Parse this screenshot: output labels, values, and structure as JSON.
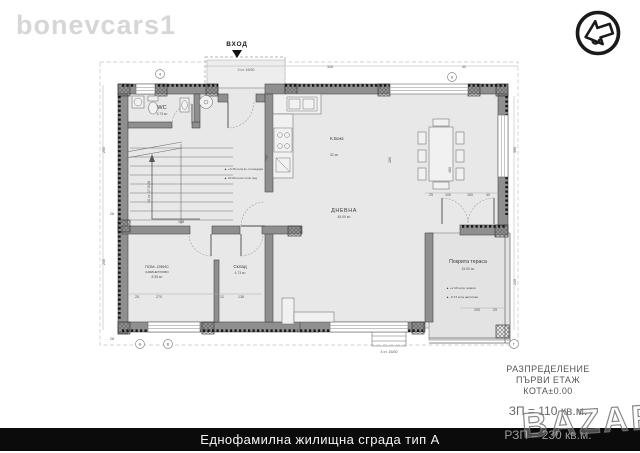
{
  "brand": "bonevcars1",
  "bazar_watermark": "BAZAR",
  "logo": {
    "name": "arrow-logo"
  },
  "footer": {
    "title": "Еднофамилна жилищна сграда тип А"
  },
  "title_block": {
    "line1": "РАЗПРЕДЕЛЕНИЕ",
    "line2": "ПЪРВИ ЕТАЖ",
    "line3": "КОТА±0.00",
    "zp": "ЗП = 110 кв.м.",
    "rzp": "РЗП = 230 кв.м."
  },
  "plan": {
    "entrance_label": "ВХОД",
    "rooms": {
      "wc": {
        "name": "WC",
        "area": "3.73 м²"
      },
      "kitchen": {
        "name": "К.Бокс",
        "area": "32 м²"
      },
      "living": {
        "name": "ДНЕВНА",
        "area": "45.00 м²"
      },
      "storage": {
        "name": "Склад",
        "area": "4.73 м²"
      },
      "office": {
        "name": "ПОМ.-ОФИС",
        "name2": "КАБИНЕТ/ХОБИ",
        "area": "8.36 м²"
      },
      "terrace": {
        "name": "Покрита тераса",
        "area": "15.00 м²"
      }
    },
    "notes": {
      "entry_steps": "3 ст. 15/30",
      "stairs": "16 ст. 17.5/28",
      "terrace_steps": "4 ст. 15/30"
    },
    "annotations": [
      {
        "x": 224,
        "y": 170,
        "t": "▲ +0.15  кота вх. площадка"
      },
      {
        "x": 224,
        "y": 179,
        "t": "▲ ±0.00  кота готов под"
      },
      {
        "x": 446,
        "y": 289,
        "t": "▲ +2.10  кота тераса"
      },
      {
        "x": 446,
        "y": 298,
        "t": "▲ -0.73  кота настилка"
      }
    ],
    "dims": [
      {
        "t": "328",
        "x": 330,
        "y": 68
      },
      {
        "t": "40",
        "x": 464,
        "y": 68
      },
      {
        "t": "250",
        "x": 105,
        "y": 150,
        "r": -90
      },
      {
        "t": "230",
        "x": 105,
        "y": 262,
        "r": -90
      },
      {
        "t": "28",
        "x": 112,
        "y": 215
      },
      {
        "t": "28",
        "x": 112,
        "y": 340
      },
      {
        "t": "760",
        "x": 268,
        "y": 158,
        "r": -90
      },
      {
        "t": "180",
        "x": 391,
        "y": 160,
        "r": -90
      },
      {
        "t": "480",
        "x": 451,
        "y": 170,
        "r": -90
      },
      {
        "t": "25",
        "x": 431,
        "y": 196
      },
      {
        "t": "100",
        "x": 448,
        "y": 196
      },
      {
        "t": "100",
        "x": 470,
        "y": 196
      },
      {
        "t": "40",
        "x": 488,
        "y": 196
      },
      {
        "t": "148",
        "x": 181,
        "y": 223
      },
      {
        "t": "25",
        "x": 137,
        "y": 298
      },
      {
        "t": "270",
        "x": 159,
        "y": 298
      },
      {
        "t": "12",
        "x": 222,
        "y": 298
      },
      {
        "t": "138",
        "x": 241,
        "y": 298
      },
      {
        "t": "200",
        "x": 477,
        "y": 311
      },
      {
        "t": "25",
        "x": 495,
        "y": 311
      },
      {
        "t": "390",
        "x": 516,
        "y": 150,
        "r": -90
      },
      {
        "t": "245",
        "x": 516,
        "y": 282,
        "r": -90
      }
    ],
    "axes": [
      {
        "t": "4",
        "x": 160,
        "y": 74
      },
      {
        "t": "6",
        "x": 452,
        "y": 77
      },
      {
        "t": "Б",
        "x": 140,
        "y": 344
      },
      {
        "t": "В",
        "x": 168,
        "y": 344
      },
      {
        "t": "Г",
        "x": 514,
        "y": 344
      }
    ]
  },
  "colors": {
    "wall": "#8f8f8f",
    "floor": "#e8e8e8",
    "terrace_floor": "#e3e3e3",
    "footer_bar": "#0b0b0b"
  }
}
